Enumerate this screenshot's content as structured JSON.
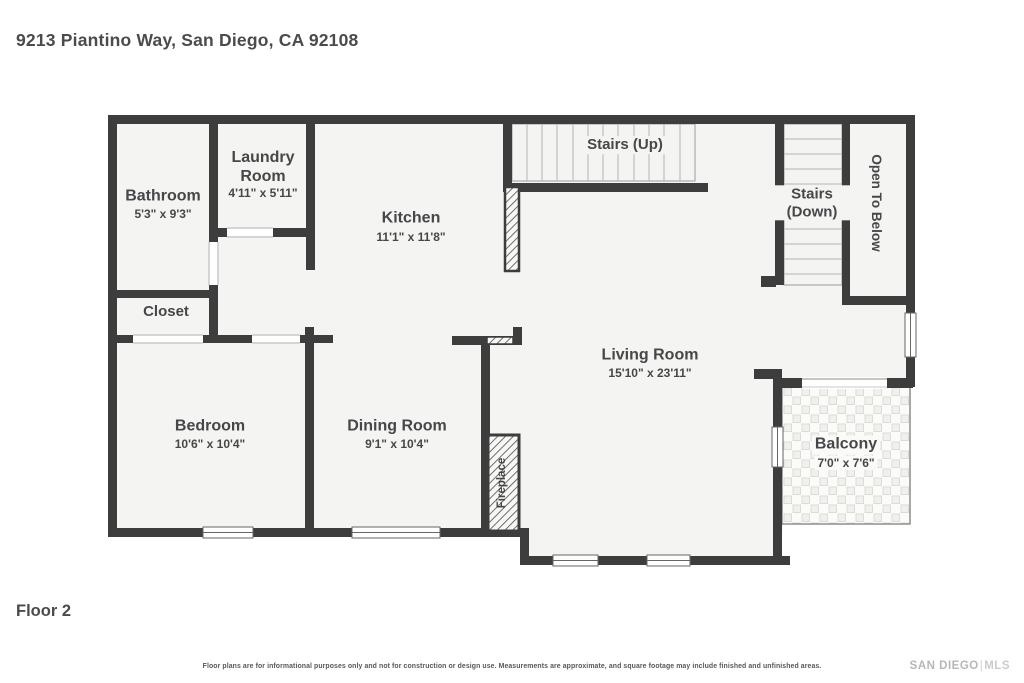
{
  "page": {
    "address": "9213 Piantino Way, San Diego, CA 92108",
    "floor_label": "Floor 2",
    "disclaimer": "Floor plans are for informational purposes only and not for construction or design use. Measurements are approximate, and square footage may include finished and unfinished areas.",
    "brand": {
      "name": "SAN DIEGO",
      "divider": "|",
      "suffix": "MLS"
    }
  },
  "colors": {
    "wall": "#3d3d3d",
    "floor": "#f4f4f2",
    "label": "#47474a",
    "tread_line": "#b3b3b3"
  },
  "rooms": {
    "bathroom": {
      "name": "Bathroom",
      "dims": "5'3\" x 9'3\""
    },
    "laundry": {
      "name": "Laundry Room",
      "dims": "4'11\" x 5'11\""
    },
    "kitchen": {
      "name": "Kitchen",
      "dims": "11'1\" x 11'8\""
    },
    "stairs_up": {
      "name": "Stairs (Up)"
    },
    "stairs_down": {
      "name": "Stairs (Down)"
    },
    "open_to_below": {
      "name": "Open To Below"
    },
    "closet": {
      "name": "Closet"
    },
    "living_room": {
      "name": "Living Room",
      "dims": "15'10\" x 23'11\""
    },
    "bedroom": {
      "name": "Bedroom",
      "dims": "10'6\" x 10'4\""
    },
    "dining_room": {
      "name": "Dining Room",
      "dims": "9'1\" x 10'4\""
    },
    "fireplace": {
      "name": "Fireplace"
    },
    "balcony": {
      "name": "Balcony",
      "dims": "7'0\" x 7'6\""
    }
  }
}
